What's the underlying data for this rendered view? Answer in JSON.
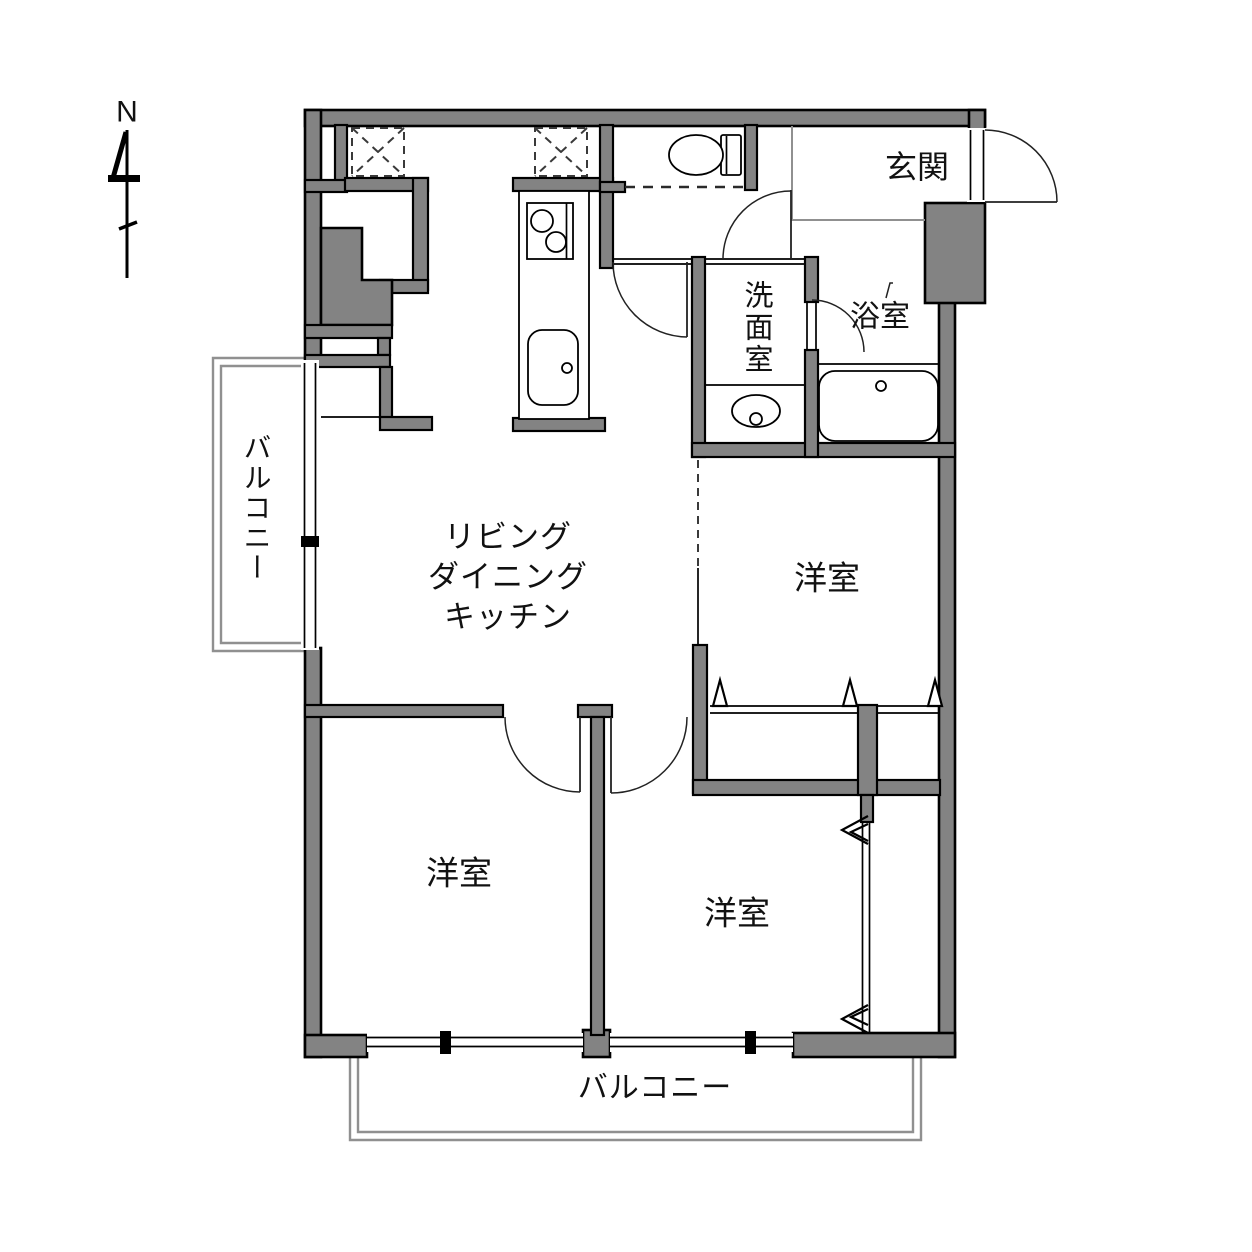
{
  "compass": {
    "label": "N"
  },
  "rooms": {
    "ldk": {
      "lines": [
        "リビング",
        "ダイニング",
        "キッチン"
      ]
    },
    "bedroom_ne": {
      "label": "洋室"
    },
    "bedroom_sw": {
      "label": "洋室"
    },
    "bedroom_se": {
      "label": "洋室"
    },
    "entrance": {
      "label": "玄関"
    },
    "washroom": {
      "label": "洗面室"
    },
    "bathroom": {
      "label": "浴室"
    }
  },
  "balconies": {
    "left": {
      "label": "バルコニー"
    },
    "bottom": {
      "label": "バルコニー"
    }
  },
  "colors": {
    "wall_fill": "#838383",
    "line": "#000000",
    "balcony_line": "#909090",
    "background": "#ffffff",
    "label": "#111111"
  }
}
